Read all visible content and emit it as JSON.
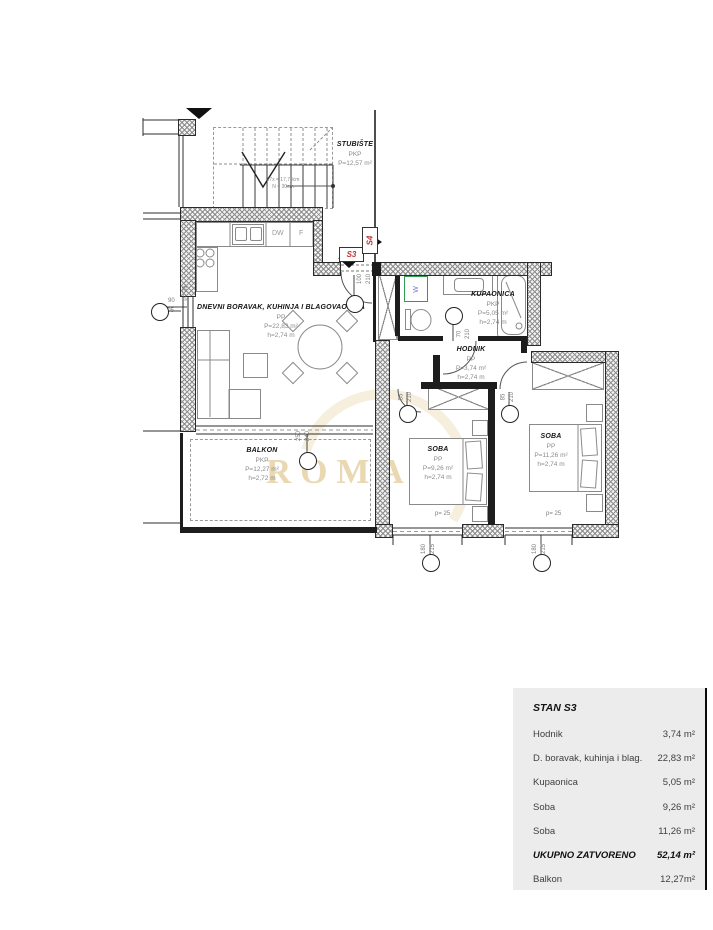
{
  "unit_labels": {
    "current": "S3",
    "adjacent": "S4"
  },
  "stairs": {
    "name": "STUBIŠTE",
    "tenure": "PKP",
    "area": "P=12,57 m²",
    "note1": "17x = 17,78cm",
    "note2": "N = 30cm"
  },
  "rooms": [
    {
      "name": "DNEVNI BORAVAK, KUHINJA I BLAGOVAONICA",
      "tenure": "PP",
      "area": "P=22,83 m²",
      "height": "h=2,74 m"
    },
    {
      "name": "KUPAONICA",
      "tenure": "PKP",
      "area": "P=5,05 m²",
      "height": "h=2,74 m"
    },
    {
      "name": "HODNIK",
      "tenure": "PP",
      "area": "P=3,74 m²",
      "height": "h=2,74 m"
    },
    {
      "name": "SOBA",
      "tenure": "PP",
      "area": "P=9,26 m²",
      "height": "h=2,74 m"
    },
    {
      "name": "SOBA",
      "tenure": "PP",
      "area": "P=11,26 m²",
      "height": "h=2,74 m"
    },
    {
      "name": "BALKON",
      "tenure": "PKP",
      "area": "P=12,27 m²",
      "height": "h=2,72 m"
    }
  ],
  "appliances": {
    "dishwasher": "DW",
    "fridge": "F",
    "washer": "W"
  },
  "dimensions": {
    "window_left": {
      "w": "90",
      "h": "205"
    },
    "entry_door": {
      "w": "100",
      "h": "210"
    },
    "bath_door": {
      "w": "70",
      "h": "210"
    },
    "soba1_door": {
      "w": "85",
      "h": "210"
    },
    "soba2_door": {
      "w": "85",
      "h": "210"
    },
    "balcony_door": {
      "w": "250",
      "h": "240"
    },
    "window1": {
      "w": "180",
      "h": "215"
    },
    "window2": {
      "w": "180",
      "h": "215"
    },
    "parapet1": "p= 25",
    "parapet2": "p= 25",
    "parapet3": "p= 25"
  },
  "watermark": "ROMANO",
  "area_table": {
    "title": "STAN S3",
    "rows": [
      {
        "label": "Hodnik",
        "value": "3,74 m²"
      },
      {
        "label": "D. boravak, kuhinja i blag.",
        "value": "22,83 m²"
      },
      {
        "label": "Kupaonica",
        "value": "5,05 m²"
      },
      {
        "label": "Soba",
        "value": "9,26 m²"
      },
      {
        "label": "Soba",
        "value": "11,26 m²"
      },
      {
        "label": "UKUPNO ZATVORENO",
        "value": "52,14 m²"
      },
      {
        "label": "Balkon",
        "value": "12,27m²"
      }
    ]
  },
  "colors": {
    "unit_label_red": "#c23030",
    "washer_box_green": "#2f9e4f",
    "washer_letter_blue": "#7878d8",
    "watermark_gold": "#e9d8b2",
    "table_bg": "#ececec"
  }
}
